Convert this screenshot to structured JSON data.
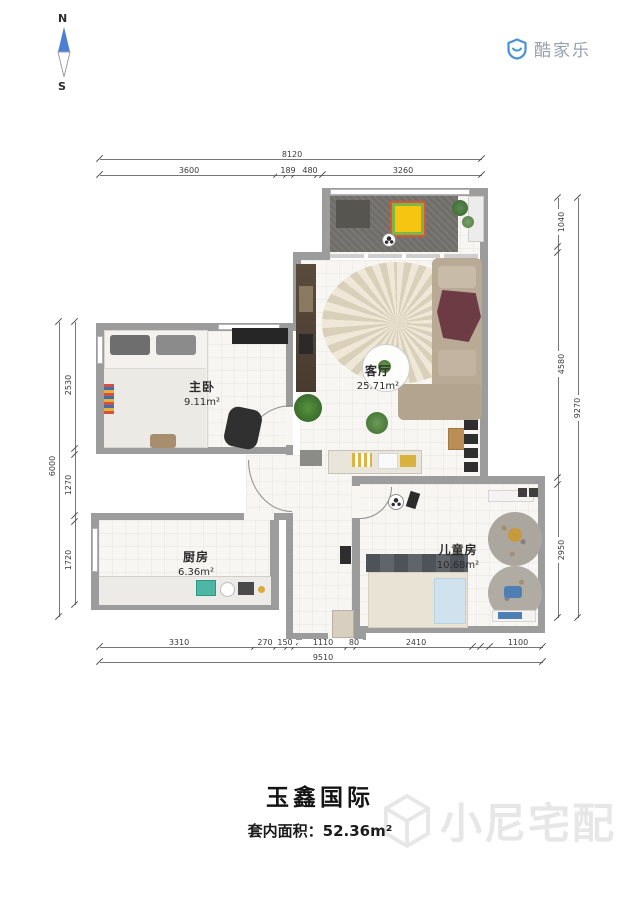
{
  "compass": {
    "north": "N",
    "south": "S",
    "needle_color": "#4a7fd4"
  },
  "logo": {
    "text": "酷家乐",
    "icon": "shield-smile-icon",
    "icon_color": "#4a90d9",
    "text_color": "#98a1aa"
  },
  "plan": {
    "wall_color": "#9c9c9c",
    "rooms": [
      {
        "id": "master",
        "name": "主卧",
        "area": "9.11m²"
      },
      {
        "id": "living",
        "name": "客厅",
        "area": "25.71m²"
      },
      {
        "id": "kitchen",
        "name": "厨房",
        "area": "6.36m²"
      },
      {
        "id": "kids",
        "name": "儿童房",
        "area": "10.68m²"
      }
    ]
  },
  "dimensions": {
    "top": {
      "overall": "8120",
      "segments": [
        "3600",
        "189",
        "480",
        "3260"
      ]
    },
    "bottom": {
      "overall": "9510",
      "segments": [
        "3310",
        "270",
        "150",
        "1110",
        "80",
        "2410",
        "1100"
      ]
    },
    "left": {
      "overall": "6000",
      "segments": [
        "2530",
        "1270",
        "1720"
      ]
    },
    "right": {
      "overall": "9270",
      "segments": [
        "1040",
        "4580",
        "2950"
      ]
    }
  },
  "footer": {
    "title": "玉鑫国际",
    "area_label": "套内面积：",
    "area_value": "52.36m²"
  },
  "watermark": {
    "text": "小尼宅配",
    "icon": "cube-icon"
  }
}
